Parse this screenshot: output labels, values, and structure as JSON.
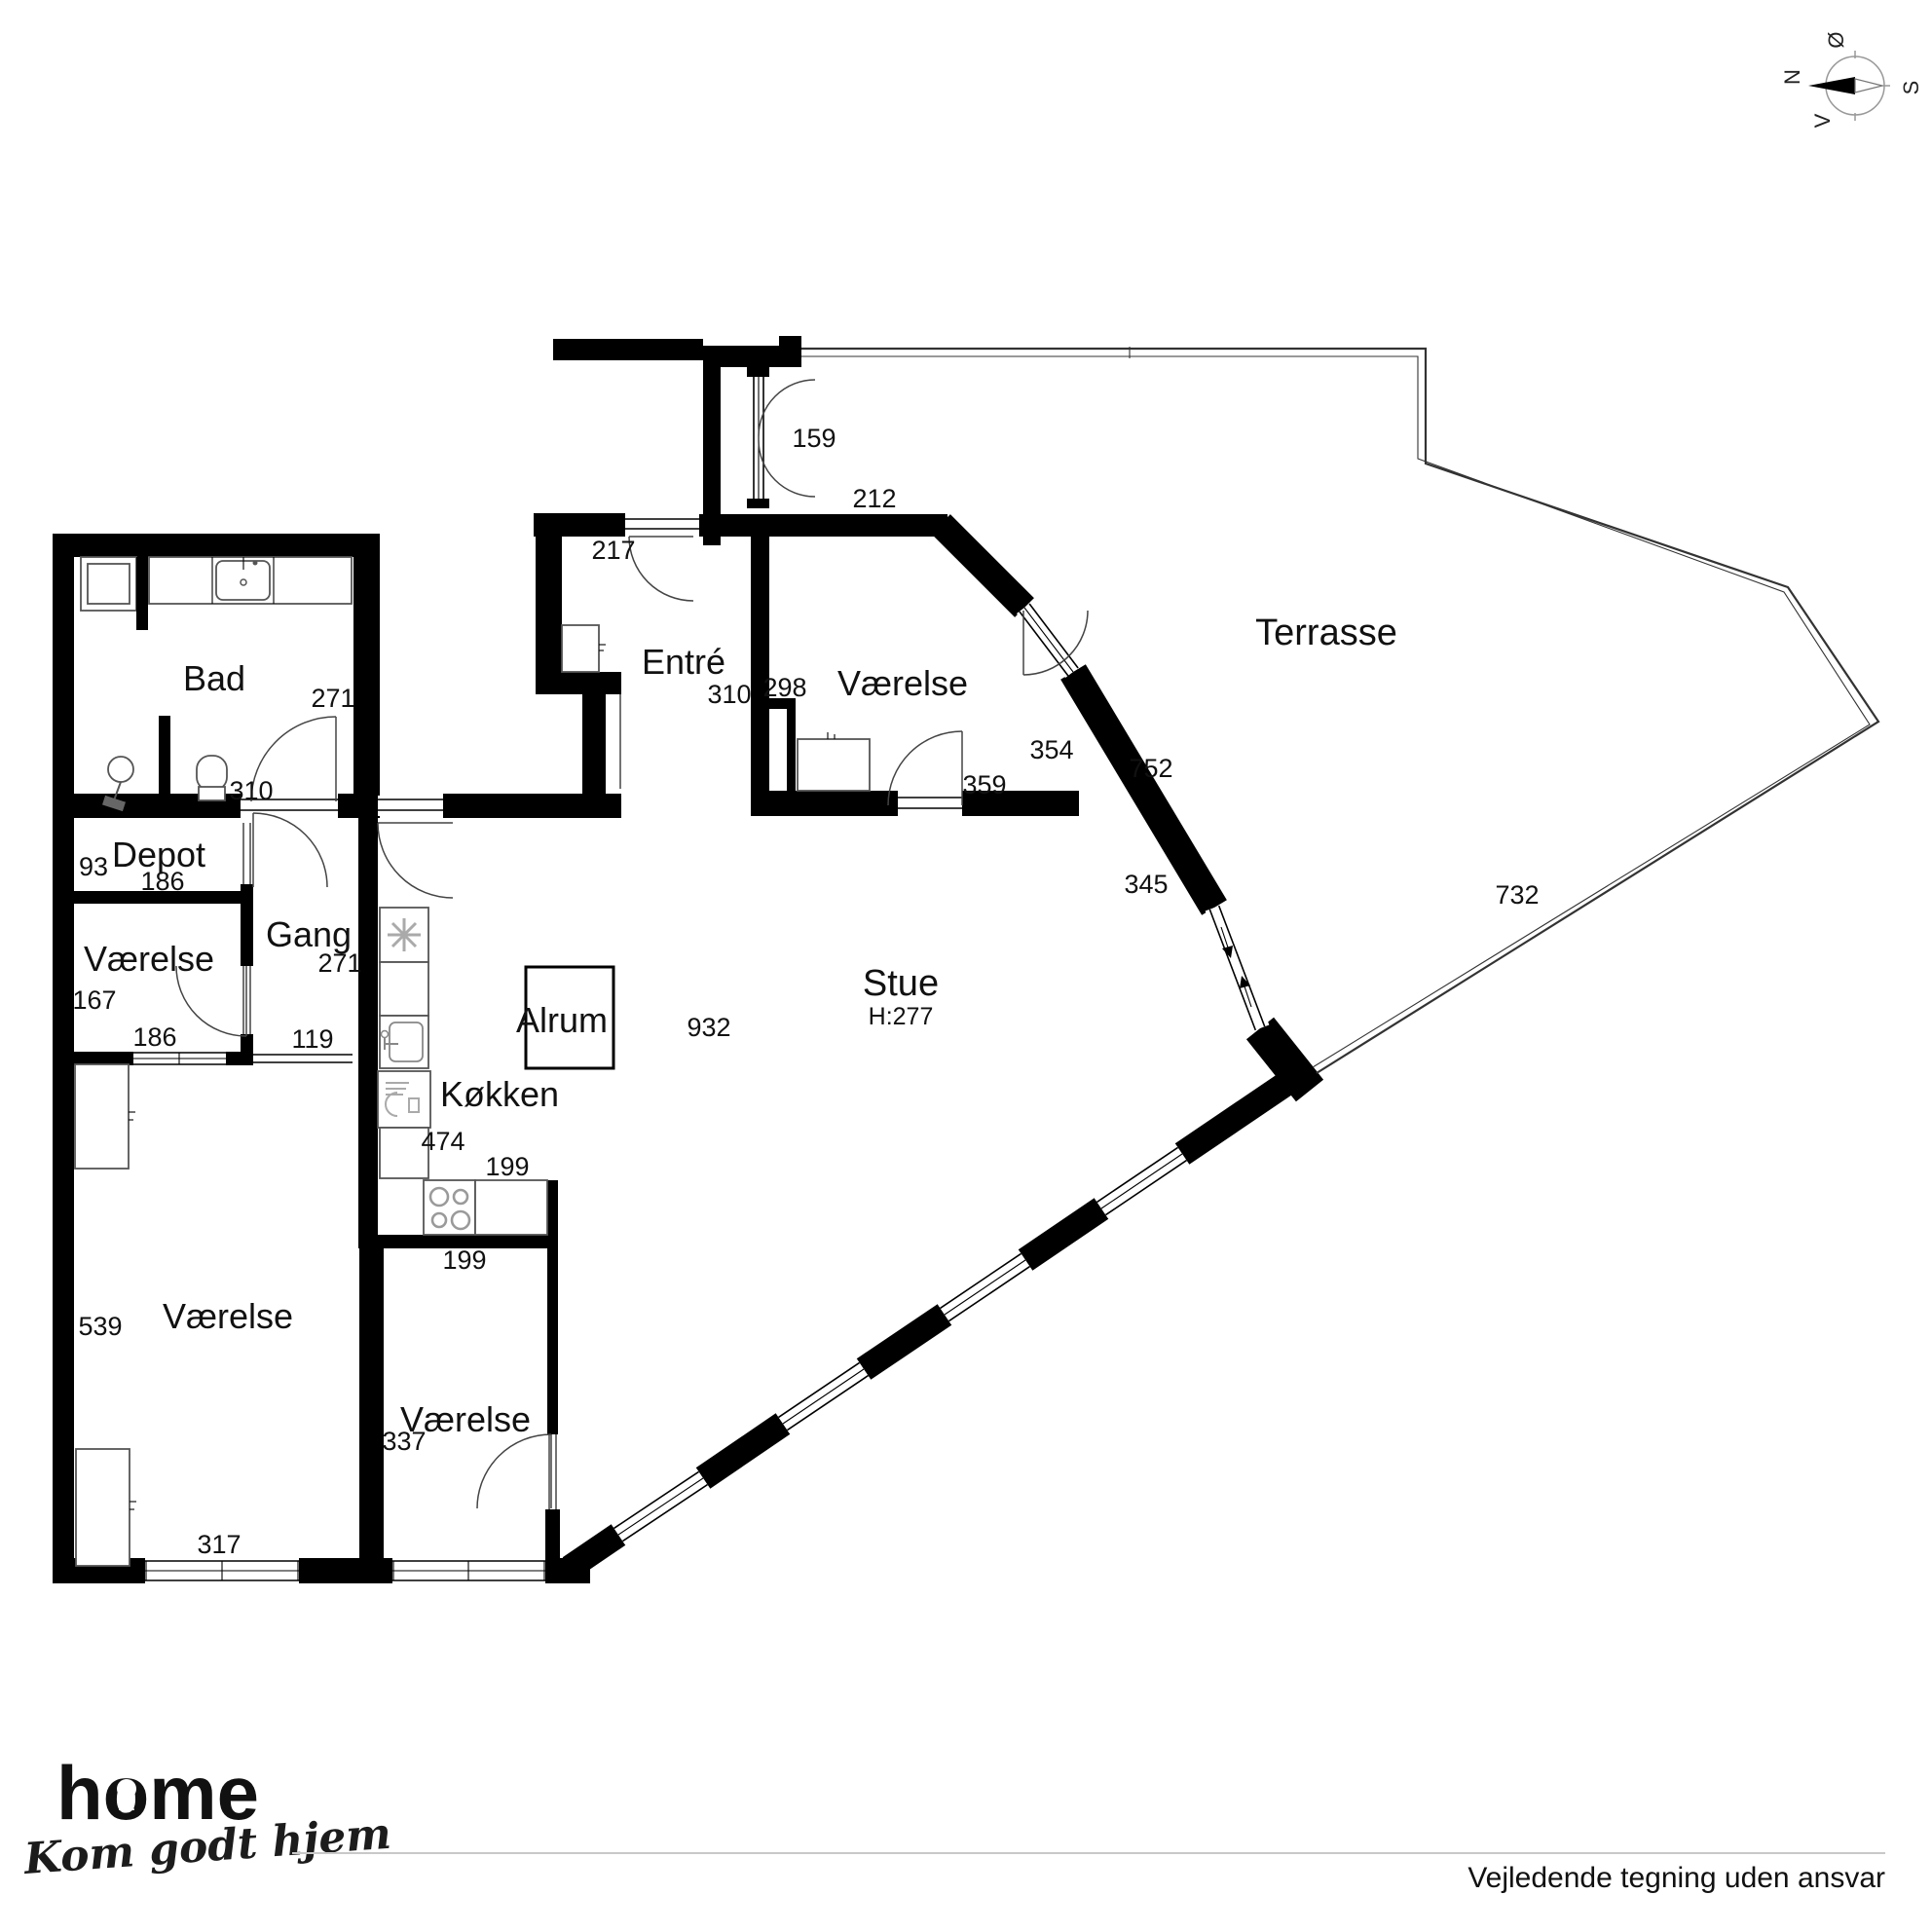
{
  "labels": {
    "bad": "Bad",
    "bad_dim_h": "271",
    "bad_dim_w": "310",
    "depot": "Depot",
    "depot_dim_h": "93",
    "depot_dim_w": "186",
    "vaerelse_nw": "Værelse",
    "vaerelse_nw_dim_h": "167",
    "vaerelse_nw_dim_w": "186",
    "gang": "Gang",
    "gang_dim_h": "271",
    "gang_dim_opening": "119",
    "koekken": "Køkken",
    "koekken_dim_run": "474",
    "koekken_dim_counter": "199",
    "koekken_dim_room": "199",
    "entre": "Entré",
    "entre_dim_door": "217",
    "entre_dim_w": "310",
    "vaerelse_n": "Værelse",
    "vaerelse_n_dim_w": "298",
    "vaerelse_n_dim_wall": "212",
    "vaerelse_n_dim_balcony_door": "159",
    "vaerelse_n_dim_window": "354",
    "vaerelse_n_dim_door": "359",
    "stue": "Stue",
    "stue_ceiling_height": "H:277",
    "stue_dim_wall": "752",
    "stue_dim_sliding_door": "345",
    "stue_dim_window_wall": "932",
    "alrum": "Alrum",
    "vaerelse_sw": "Værelse",
    "vaerelse_sw_dim_h": "539",
    "vaerelse_sw_dim_w": "317",
    "vaerelse_s": "Værelse",
    "vaerelse_s_dim": "337",
    "terrasse": "Terrasse",
    "terrasse_dim": "732"
  },
  "compass": {
    "north": "N",
    "south": "S",
    "east": "Ø",
    "west": "V"
  },
  "footer": {
    "logo": "home",
    "tagline": "Kom godt hjem",
    "disclaimer": "Vejledende tegning uden ansvar"
  },
  "colors": {
    "brand_red": "#e8192c",
    "wall_black": "#000000",
    "line_gray": "#c8c8c8"
  }
}
